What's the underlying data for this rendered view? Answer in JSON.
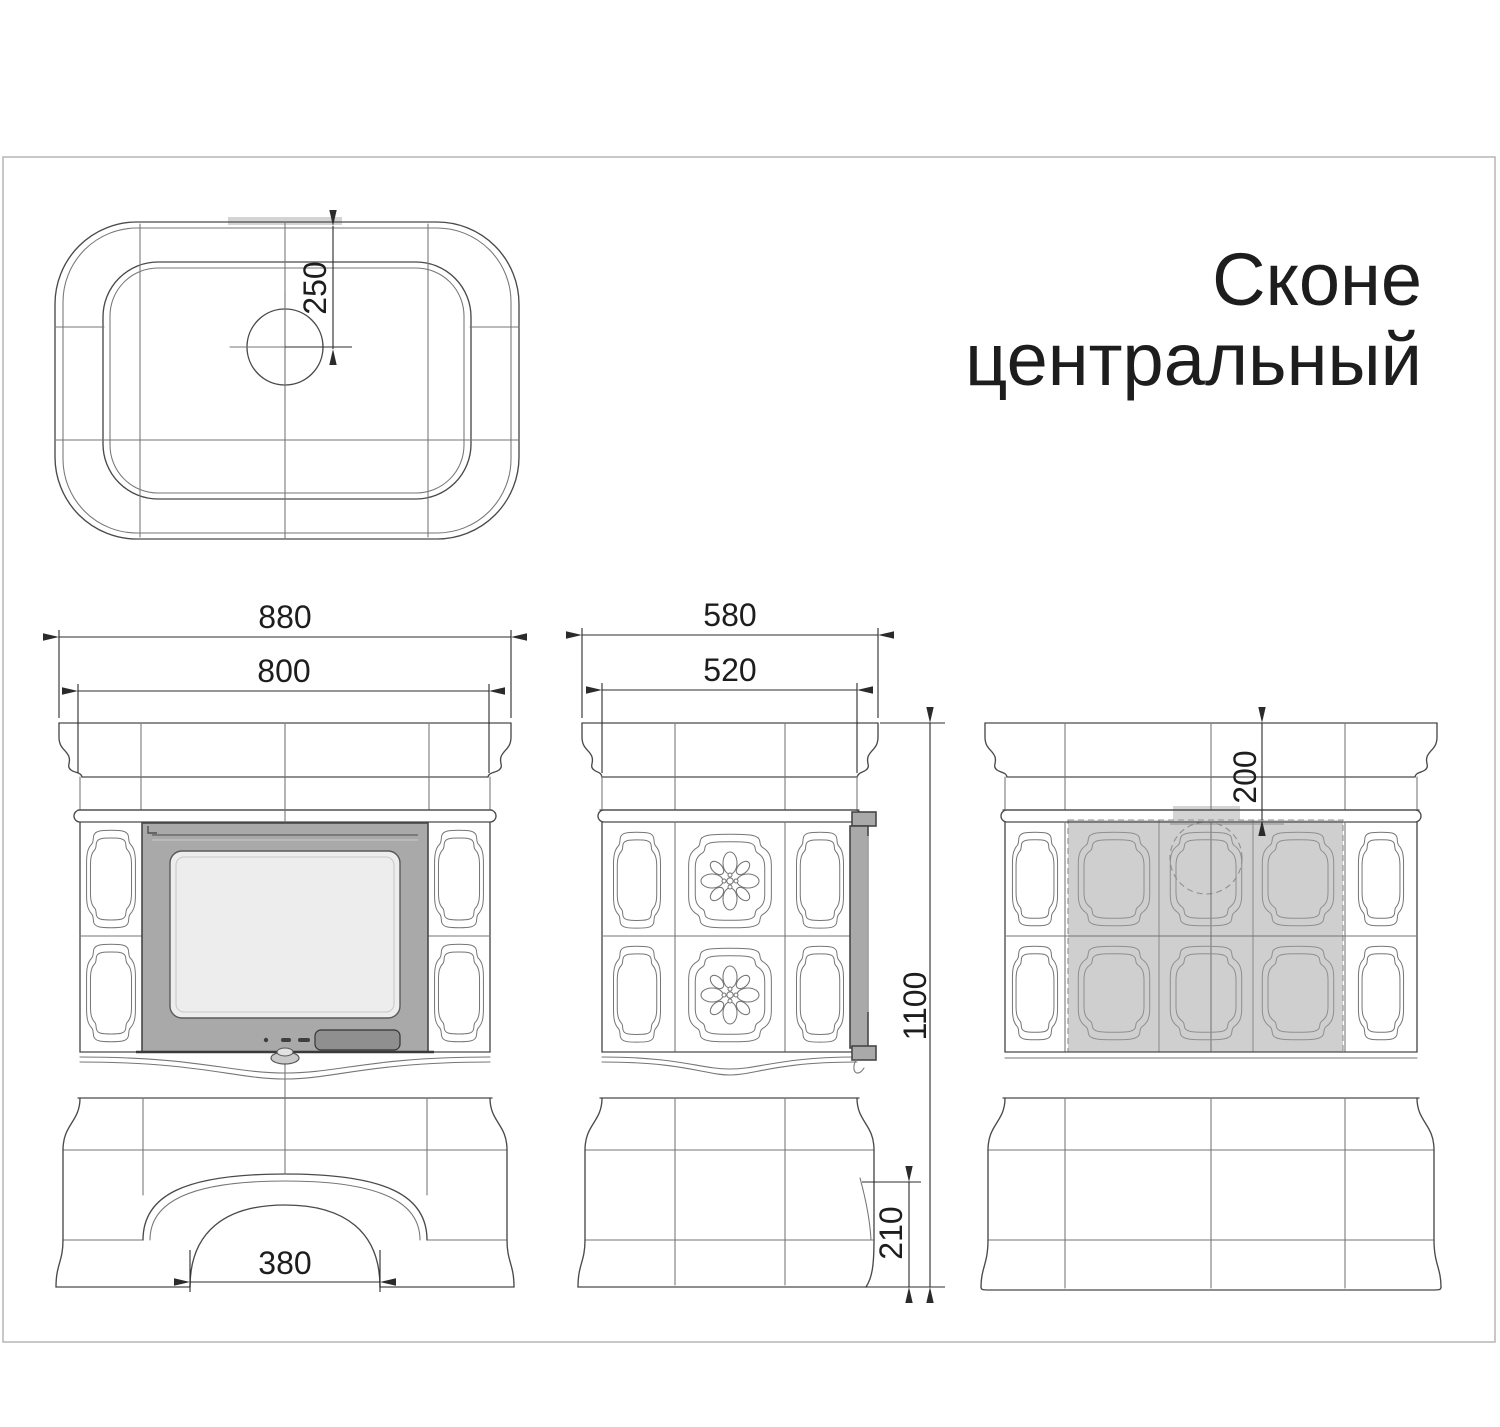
{
  "title": {
    "line1": "Сконе",
    "line2": "центральный"
  },
  "dimensions": {
    "top_flue_offset": "250",
    "front_width_overall": "880",
    "front_width_body": "800",
    "front_arch_width": "380",
    "side_depth_overall": "580",
    "side_depth_body": "520",
    "height_overall": "1100",
    "side_base_recess_height": "210",
    "back_flue_offset": "200"
  },
  "colors": {
    "line": "#4a4a4a",
    "tile": "#757575",
    "door_frame": "#a9a9a9",
    "door_glass": "#ededed",
    "handle": "#8f8f8f",
    "shaded_fill": "#cfcfcf",
    "shaded_outline": "#8f8f8f",
    "dim": "#2b2b2b",
    "text": "#1d1d1d",
    "border": "#b5b5b5"
  }
}
